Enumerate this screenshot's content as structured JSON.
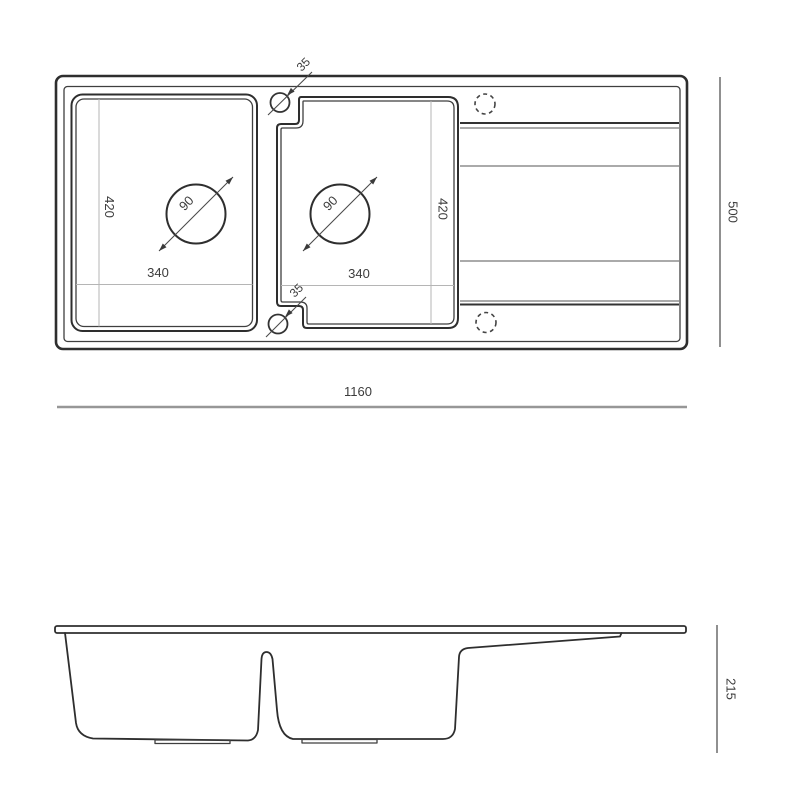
{
  "colors": {
    "background": "#ffffff",
    "outline": "#2e2e2e",
    "dimension_overall_line": "#979797",
    "dimension_side_line": "#606060",
    "dimension_inner_line": "#b5b5b5",
    "label_text": "#3c3c3c"
  },
  "top_view": {
    "overall": {
      "width_label": "1160",
      "depth_label": "500"
    },
    "left_bowl": {
      "width_label": "340",
      "depth_label": "420",
      "drain_diameter_label": "90"
    },
    "right_bowl": {
      "width_label": "340",
      "depth_label": "420",
      "drain_diameter_label": "90"
    },
    "mounting_holes": {
      "top_offset_label": "35",
      "bottom_offset_label": "35"
    }
  },
  "side_view": {
    "height_label": "215"
  }
}
